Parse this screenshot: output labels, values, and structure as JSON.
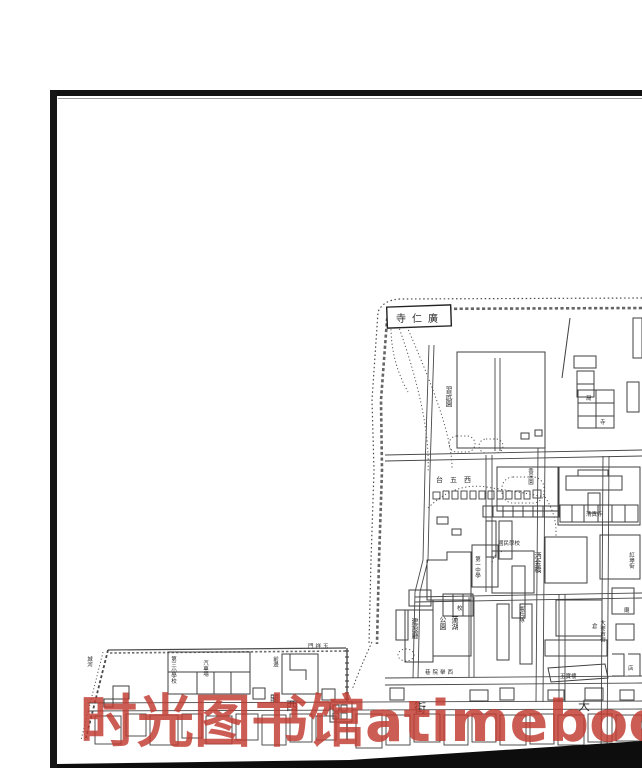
{
  "watermark": {
    "text": "时光图书馆atimebook.com",
    "color": "#c23a30"
  },
  "page": {
    "frame_color": "#111111",
    "background": "#ffffff"
  },
  "map": {
    "labels": [
      {
        "text": "寺仁廣"
      },
      {
        "text": "習武園"
      },
      {
        "text": "台五西"
      },
      {
        "text": "香米園"
      },
      {
        "text": "洒金橋"
      },
      {
        "text": "第一中學"
      },
      {
        "text": "蓮湖"
      },
      {
        "text": "公園"
      },
      {
        "text": "建設廳"
      },
      {
        "text": "巷院舉西"
      },
      {
        "text": "門祥玉"
      },
      {
        "text": "閣"
      },
      {
        "text": "西"
      },
      {
        "text": "街"
      },
      {
        "text": "大"
      },
      {
        "text": "第三小學校"
      },
      {
        "text": "汽車場"
      },
      {
        "text": "前邊"
      },
      {
        "text": "憲兵隊"
      },
      {
        "text": "國民學校"
      },
      {
        "text": "玉寶樓"
      },
      {
        "text": "大麥市街"
      },
      {
        "text": "紅埠街"
      },
      {
        "text": "城河"
      },
      {
        "text": "清真寺"
      },
      {
        "text": "局"
      },
      {
        "text": "寺"
      },
      {
        "text": "倉"
      },
      {
        "text": "校"
      },
      {
        "text": "廟"
      },
      {
        "text": "店"
      }
    ]
  }
}
